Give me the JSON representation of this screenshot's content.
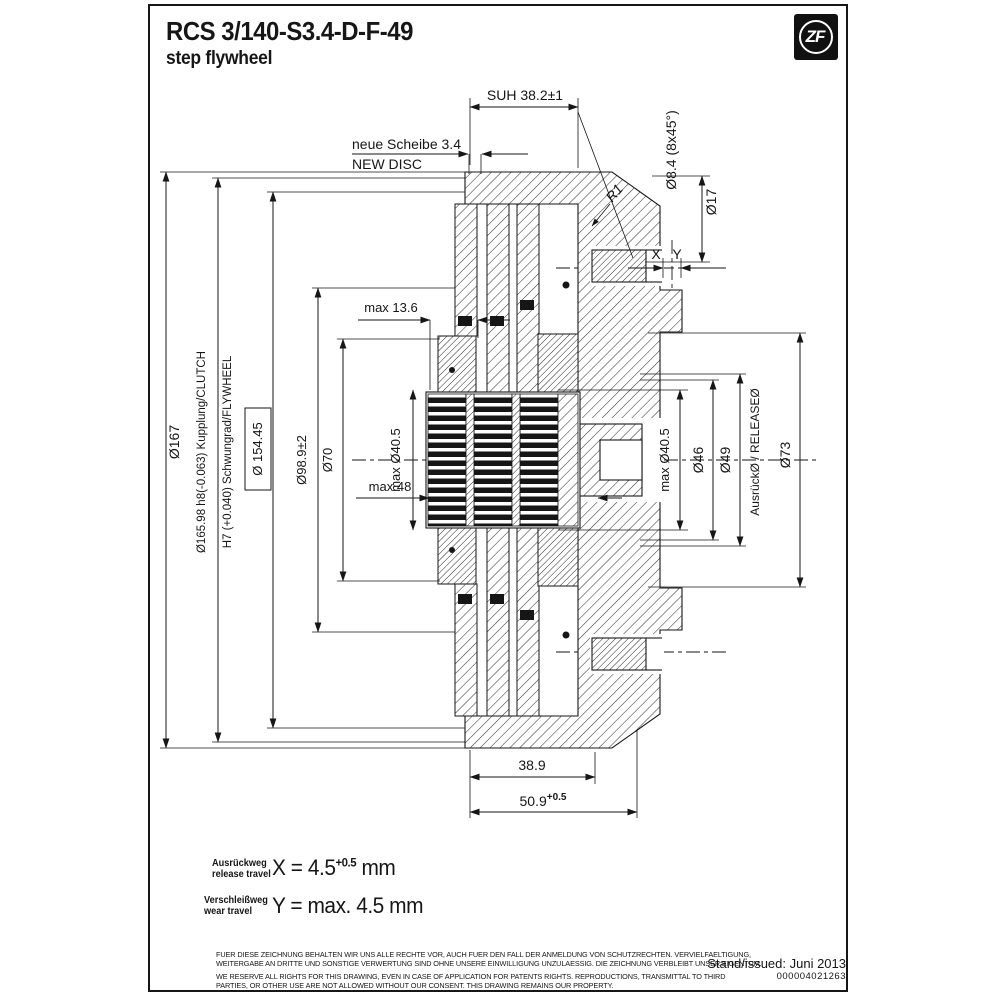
{
  "title": {
    "model": "RCS 3/140-S3.4-D-F-49",
    "subtitle": "step flywheel"
  },
  "logo": {
    "text": "ZF"
  },
  "dims": {
    "suh": "SUH 38.2±1",
    "chamfer": "Ø8.4 (8x45°)",
    "d17": "Ø17",
    "r1": "R1",
    "new_disc_de": "neue Scheibe 3.4",
    "new_disc_en": "NEW DISC",
    "x": "X",
    "y": "Y",
    "d167": "Ø167",
    "d165": "Ø165.98 h8(-0.063) Kupplung/CLUTCH",
    "h7": "H7 (+0.040) Schwungrad/FLYWHEEL",
    "d154": "Ø 154.45",
    "d98": "Ø98.9±2",
    "d70": "Ø70",
    "max136": "max 13.6",
    "max48": "max 48",
    "max405_left": "max Ø40.5",
    "max405_right": "max Ø40.5",
    "d46": "Ø46",
    "d49": "Ø49",
    "release": "AusrückØ / RELEASEØ",
    "d73": "Ø73",
    "d389": "38.9",
    "d509": "50.9",
    "d509_tol": "+0.5"
  },
  "legend": {
    "rows": [
      {
        "de": "Ausrückweg",
        "en": "release travel",
        "eq": "X = 4.5",
        "sup": "+0.5",
        "unit": " mm"
      },
      {
        "de": "Verschleißweg",
        "en": "wear travel",
        "eq": "Y = max. 4.5 mm"
      }
    ]
  },
  "footer": {
    "de1": "FUER DIESE ZEICHNUNG BEHALTEN WIR UNS ALLE RECHTE VOR, AUCH FUER DEN FALL DER ANMELDUNG VON SCHUTZRECHTEN. VERVIELFAELTIGUNG,",
    "de2": "WEITERGABE AN DRITTE UND SONSTIGE VERWERTUNG SIND OHNE UNSERE EINWILLIGUNG UNZULAESSIG. DIE ZEICHNUNG VERBLEIBT UNSER EIGENTUM.",
    "en1": "WE RESERVE ALL RIGHTS FOR THIS DRAWING, EVEN IN CASE OF APPLICATION FOR PATENTS RIGHTS. REPRODUCTIONS, TRANSMITTAL TO THIRD",
    "en2": "PARTIES, OR OTHER USE ARE NOT ALLOWED WITHOUT OUR CONSENT. THIS DRAWING REMAINS OUR PROPERTY.",
    "issued": "Stand/issued: Juni 2013",
    "doc_number": "000004021263"
  },
  "colors": {
    "ink": "#161616",
    "bg": "#ffffff"
  }
}
